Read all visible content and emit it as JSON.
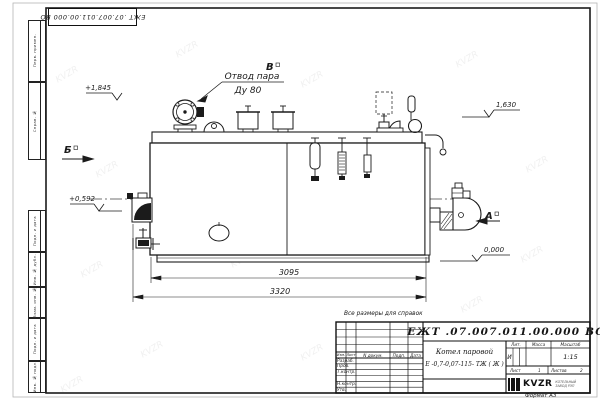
{
  "frame": {
    "stamp_doc_number": "ЕЖТ .07.007.011.00.000  ВО",
    "format_label": "Формат А3",
    "watermark_text": "KVZR",
    "margin_labels": [
      "Перв. примен.",
      "Справ. №",
      "Подп. и дата",
      "Инв. № дубл.",
      "Взам. инв. №",
      "Подп. и дата",
      "Инв. № подл."
    ]
  },
  "note": "Все размеры для справок",
  "drawing": {
    "callout": {
      "line1": "Отвод пара",
      "line2": "Ду 80"
    },
    "elevations": {
      "steam_valve": "+1,845",
      "top_right": "1,630",
      "feed": "+0,592",
      "ground": "0,000"
    },
    "view_labels": {
      "a": "А",
      "b": "Б",
      "v": "В"
    },
    "dimensions": {
      "inner_length": "3095",
      "overall_length": "3320"
    }
  },
  "title_block": {
    "doc_number": "ЕЖТ .07.007.011.00.000  ВО",
    "name_line1": "Котел паровой",
    "name_line2": "Е -0,7-0,07-115- ТЖ ( Ж )",
    "columns": {
      "izm": "Изм.",
      "list": "Лист",
      "doc": "N докум.",
      "sign": "Подп.",
      "date": "Дата"
    },
    "roles": [
      "Разраб.",
      "Пров.",
      "Т.контр.",
      "",
      "Н.контр.",
      "Утв."
    ],
    "lit": {
      "header": "Лит.",
      "value": "И"
    },
    "mass": {
      "header": "Масса",
      "value": ""
    },
    "scale": {
      "header": "Масштаб",
      "value": "1:15"
    },
    "sheet": {
      "label": "Лист",
      "value": "1"
    },
    "sheets": {
      "label": "Листов",
      "value": "2"
    },
    "logo": {
      "text": "KVZR",
      "caption1": "КОТЕЛЬНЫЙ",
      "caption2": "ЗАВОД РЭП"
    }
  }
}
